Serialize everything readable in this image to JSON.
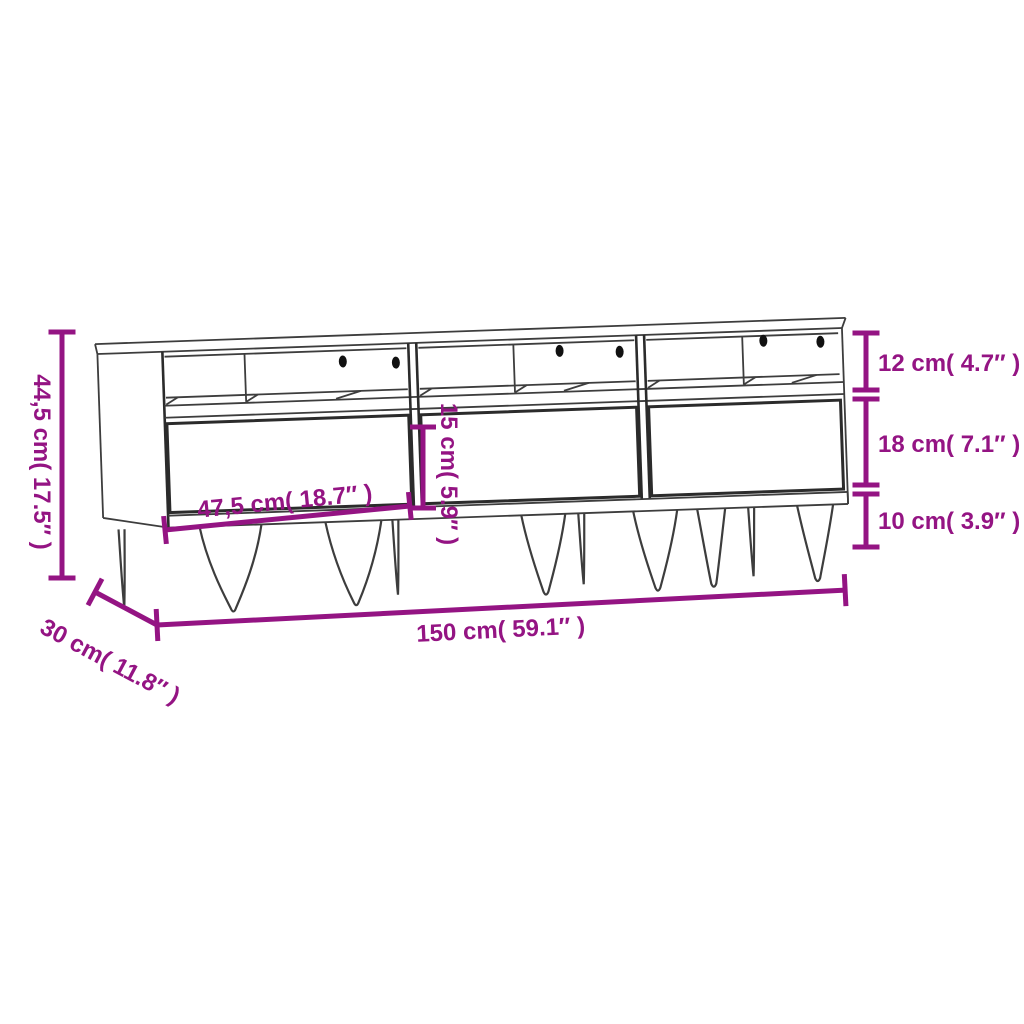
{
  "diagram": {
    "type": "product-dimensions",
    "product_name": "tv-cabinet-three-drawers-hairpin-legs",
    "background_color": "#ffffff",
    "dimension_color": "#941483",
    "outline_color": "#3d3d3d",
    "labels": {
      "total_height": "44,5 cm( 17.5″ )",
      "open_shelf_height": "12 cm( 4.7″ )",
      "drawer_section_height": "18 cm( 7.1″ )",
      "leg_height": "10 cm( 3.9″ )",
      "drawer_inner_height": "15 cm( 5.9″ )",
      "drawer_width": "47,5 cm( 18.7″ )",
      "total_width": "150 cm( 59.1″ )",
      "depth": "30 cm( 11.8″ )"
    }
  }
}
